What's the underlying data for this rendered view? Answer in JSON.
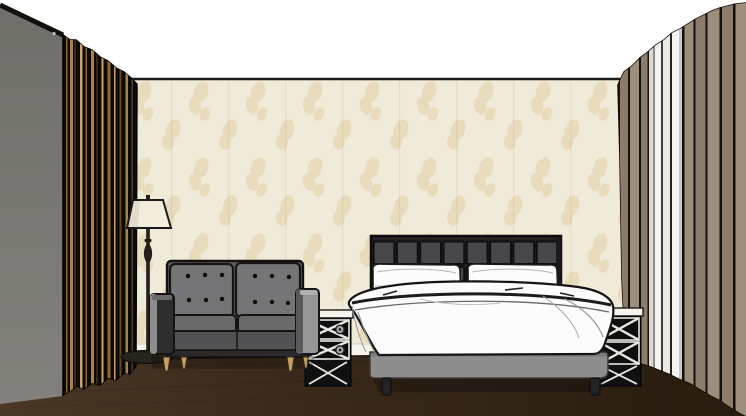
{
  "app": {
    "type": "3d-interior-render",
    "description": "Sketch-style 3D rendering of a hotel bedroom: double bed with grid-tufted headboard and white duvet, two mirrored X-front nightstands, gray tufted loveseat sofa, cream floor lamp, beige damask wallpaper, dark wood floor, black-and-gold striped curtain on the left and taupe-and-white striped curtain on the right"
  },
  "scene": {
    "objects": [
      {
        "name": "ceiling",
        "label": "White ceiling",
        "color": "#ffffff"
      },
      {
        "name": "back-wall",
        "label": "Beige damask wallpaper wall",
        "color": "#f0ead8"
      },
      {
        "name": "left-wall",
        "label": "Gray side wall",
        "color": "#7a7974"
      },
      {
        "name": "floor",
        "label": "Dark wood floor",
        "color": "#38281a"
      },
      {
        "name": "baseboard",
        "label": "White baseboard",
        "color": "#f6f4ed"
      },
      {
        "name": "left-curtain",
        "label": "Black curtain with gold stripes",
        "color": "#0d0a06"
      },
      {
        "name": "right-curtain",
        "label": "Taupe and white striped curtain",
        "color": "#9a8a78"
      },
      {
        "name": "headboard",
        "label": "Charcoal grid-tufted headboard",
        "color": "#47474b"
      },
      {
        "name": "bed",
        "label": "Double bed with white duvet and pillows",
        "color": "#fcfcfc"
      },
      {
        "name": "left-nightstand",
        "label": "Mirrored nightstand with X-front drawers",
        "color": "#141414"
      },
      {
        "name": "right-nightstand",
        "label": "Mirrored nightstand with X-front drawers",
        "color": "#141414"
      },
      {
        "name": "sofa",
        "label": "Gray button-tufted loveseat",
        "color": "#757577"
      },
      {
        "name": "floor-lamp",
        "label": "Floor lamp with cream shade",
        "color": "#f1ecdb"
      }
    ]
  },
  "palette": {
    "ceiling-white": "#ffffff",
    "wallpaper-base": "#f0ead8",
    "wallpaper-motif": "#e2cfa6",
    "wall-gray-top": "#6f6e69",
    "wall-gray-bottom": "#82817c",
    "floor-light": "#4a3726",
    "floor-mid": "#38281a",
    "floor-dark": "#281c0f",
    "baseboard": "#f6f4ed",
    "curtain-black": "#0d0a06",
    "gold": "#a8824a",
    "gold-light": "#c9a368",
    "gold-dim": "#8a6a38",
    "gold-dark": "#5f4722",
    "taupe": "#9d8d7b",
    "taupe-dark": "#8d7c6a",
    "curtain-gap-dark": "#15100b",
    "headboard-frame": "#232325",
    "headboard-cell": "#47474b",
    "bed-base-gray": "#8e8e8e",
    "bedding-white": "#fcfcfc",
    "sofa-back": "#757577",
    "sofa-seat-top": "#6a6a6a",
    "sofa-seat-front": "#525254",
    "sofa-arm-dark": "#2e2e30",
    "sofa-arm-light": "#969696",
    "leg-wood": "#c79f66",
    "lamp-shade": "#f1ecdb",
    "lamp-metal": "#211d18",
    "nightstand-dark": "#101010",
    "nightstand-white": "#e8e6e0",
    "ink": "#141414"
  }
}
